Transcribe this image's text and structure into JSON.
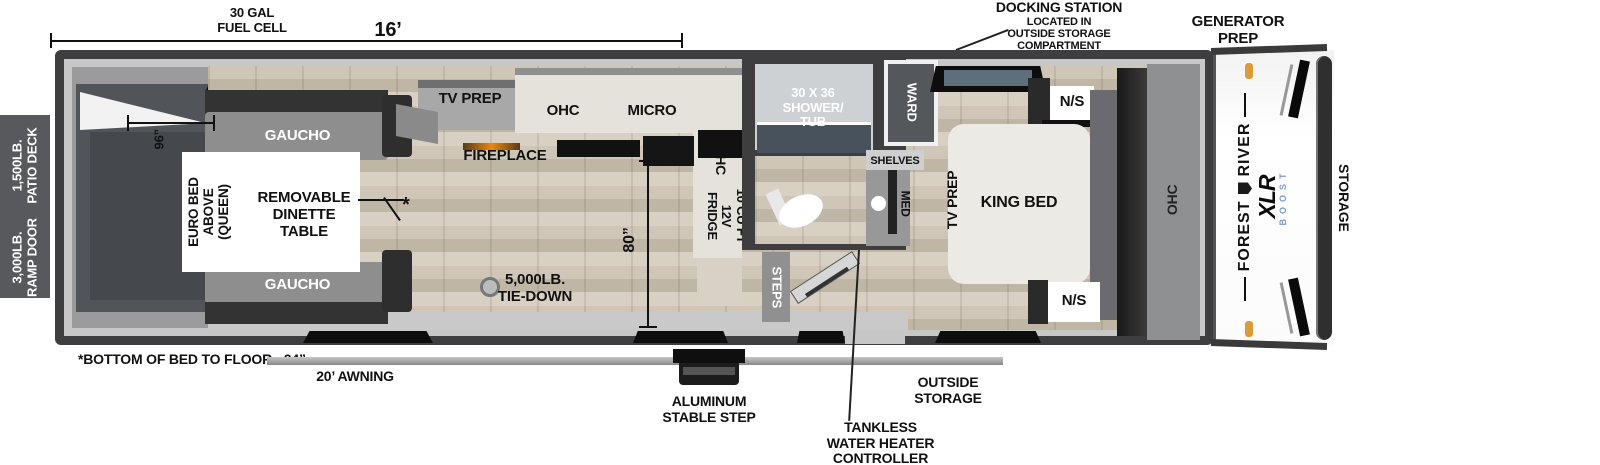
{
  "title": "Forest River XLR Boost toy hauler floor plan",
  "colors": {
    "wall": "#3e3e40",
    "wood_floor": "#c9bfb1",
    "counter": "#e4e2db",
    "shower_pan": "#47525c",
    "marker_orange": "#dd9a38",
    "boost_blue": "#7c9cc4",
    "patio_strip": "#57595c"
  },
  "top": {
    "fuel_l1": "30 GAL",
    "fuel_l2": "FUEL CELL",
    "dim16": "16’",
    "dock_l1": "DOCKING STATION",
    "dock_l2": "LOCATED IN",
    "dock_l3": "OUTSIDE STORAGE",
    "dock_l4": "COMPARTMENT",
    "gen_l1": "GENERATOR",
    "gen_l2": "PREP"
  },
  "left": {
    "patio_l1": "1,500LB.",
    "patio_l2": "PATIO DECK",
    "ramp_l1": "3,000LB.",
    "ramp_l2": "RAMP DOOR"
  },
  "bottom": {
    "note": "*BOTTOM OF BED TO FLOOR - 94”",
    "awning": "20’ AWNING",
    "step_l1": "ALUMINUM",
    "step_l2": "STABLE STEP",
    "out_l1": "OUTSIDE",
    "out_l2": "STORAGE",
    "tank_l1": "TANKLESS",
    "tank_l2": "WATER HEATER",
    "tank_l3": "CONTROLLER"
  },
  "right": {
    "storage": "STORAGE",
    "maker_l": "FOREST",
    "maker_r": "RIVER",
    "model": "XLR",
    "sub": "BOOST"
  },
  "garage": {
    "gaucho_top": "GAUCHO",
    "gaucho_bot": "GAUCHO",
    "euro_l1": "EURO BED",
    "euro_l2": "ABOVE",
    "euro_l3": "(QUEEN)",
    "din_l1": "REMOVABLE",
    "din_l2": "DINETTE",
    "din_l3": "TABLE",
    "dim96": "96”",
    "star": "*"
  },
  "kitchen": {
    "tv_prep": "TV PREP",
    "ohc": "OHC",
    "micro": "MICRO",
    "fireplace": "FIREPLACE",
    "ohc_side": "OHC",
    "fr_l1": "10 CU FT",
    "fr_l2": "12V",
    "fr_l3": "FRIDGE",
    "dim80": "80”",
    "tie_l1": "5,000LB.",
    "tie_l2": "TIE-DOWN"
  },
  "bath": {
    "steps": "STEPS",
    "sh_l1": "30 X 36",
    "sh_l2": "SHOWER/",
    "sh_l3": "TUB",
    "shelves": "SHELVES",
    "med": "MED",
    "ward": "WARD"
  },
  "bedroom": {
    "tv_prep": "TV PREP",
    "king": "KING BED",
    "ns_top": "N/S",
    "ns_bot": "N/S",
    "ohc": "OHC"
  }
}
